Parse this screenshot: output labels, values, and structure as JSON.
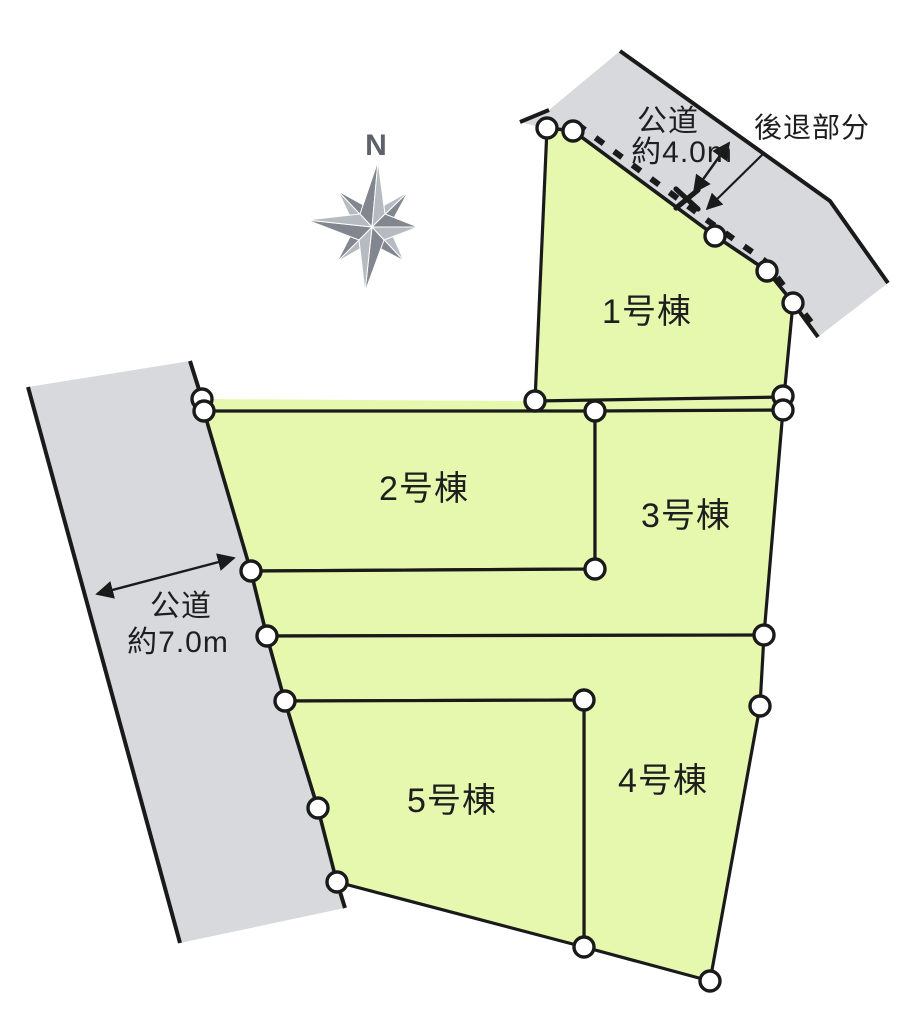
{
  "compass": {
    "label": "N"
  },
  "roads": {
    "top": {
      "name": "公道",
      "width": "約4.0m"
    },
    "left": {
      "name": "公道",
      "width": "約7.0m"
    }
  },
  "annotations": {
    "setback": "後退部分"
  },
  "lots": [
    {
      "id": 1,
      "label": "1号棟"
    },
    {
      "id": 2,
      "label": "2号棟"
    },
    {
      "id": 3,
      "label": "3号棟"
    },
    {
      "id": 4,
      "label": "4号棟"
    },
    {
      "id": 5,
      "label": "5号棟"
    }
  ],
  "colors": {
    "lot_fill": "#e6f8ae",
    "road_fill": "#d8d9dd",
    "boundary_line": "#1a1a1a",
    "vertex_marker_fill": "#ffffff",
    "compass_dark": "#82868e",
    "compass_light": "#b6bac1",
    "text": "#1e1e1e"
  }
}
